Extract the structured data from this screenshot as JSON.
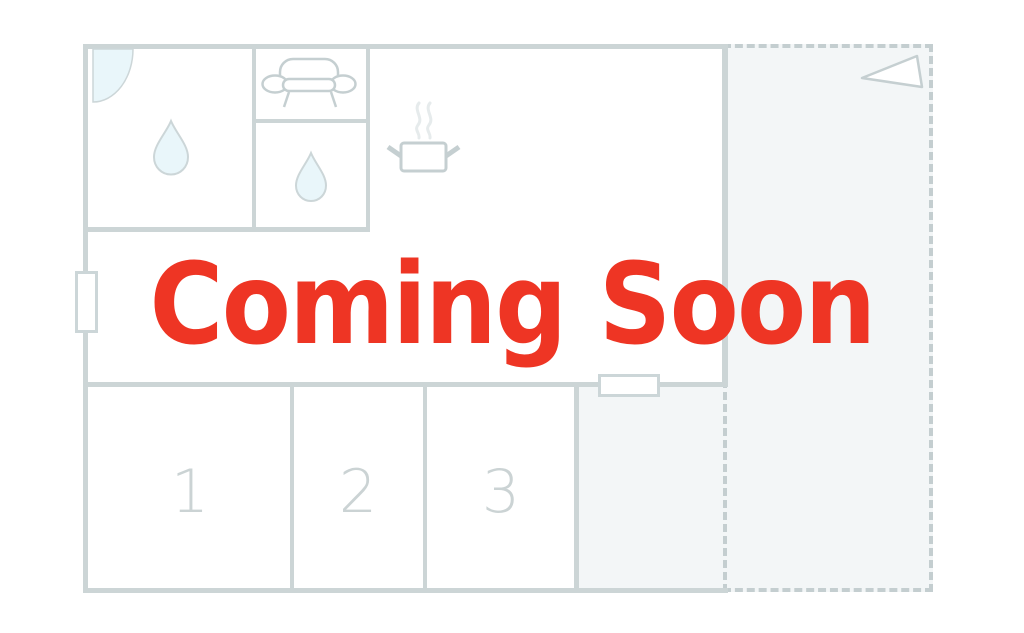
{
  "overlay": {
    "coming_soon": "Coming Soon"
  },
  "floorplan": {
    "room_labels": [
      "1",
      "2",
      "3"
    ],
    "icons": {
      "door_swing": "quarter-circle door swing",
      "water_drop": "water drop",
      "sofa": "sofa outline",
      "cooking_pot": "steaming cooking pot",
      "flag": "triangle flag pointer",
      "window_marker": "window opening in wall",
      "door_marker": "door opening in wall"
    },
    "future_area_style": "dashed outline"
  },
  "colors": {
    "accent_red": "#ee3524",
    "wall": "#ccd5d6",
    "dash": "#c4ced0",
    "icon": "#c5cfd1",
    "line": "#ccd6d8",
    "water": "#e9f6fa",
    "area": "#f3f6f7",
    "steam": "#e6ebec",
    "label": "#cbd3d4"
  }
}
